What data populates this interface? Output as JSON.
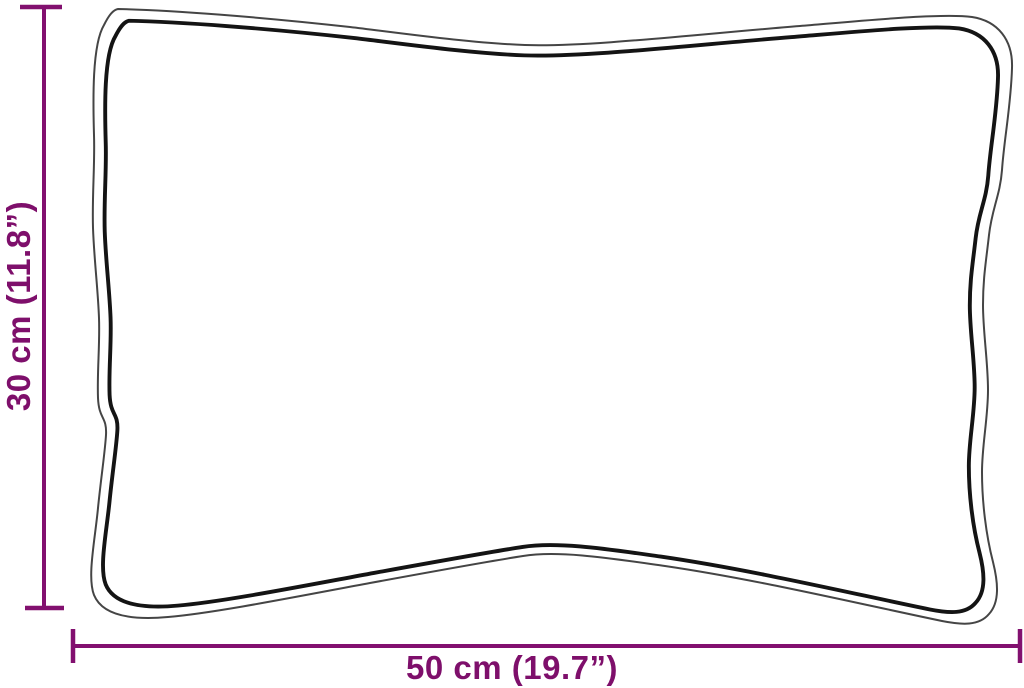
{
  "page": {
    "background": "#ffffff"
  },
  "diagram": {
    "kind": "product-dimension-diagram",
    "object": "cushion-outline-sketch",
    "dimensions": {
      "width": {
        "label": "50 cm (19.7”)",
        "value_cm": "50",
        "value_inches": "19.7"
      },
      "height": {
        "label": "30 cm (11.8”)",
        "value_cm": "30",
        "value_inches": "11.8"
      }
    },
    "colors": {
      "dimension_accent": "#82106f",
      "outline_dark": "#141414",
      "outline_light": "#454545",
      "background": "#ffffff"
    }
  }
}
